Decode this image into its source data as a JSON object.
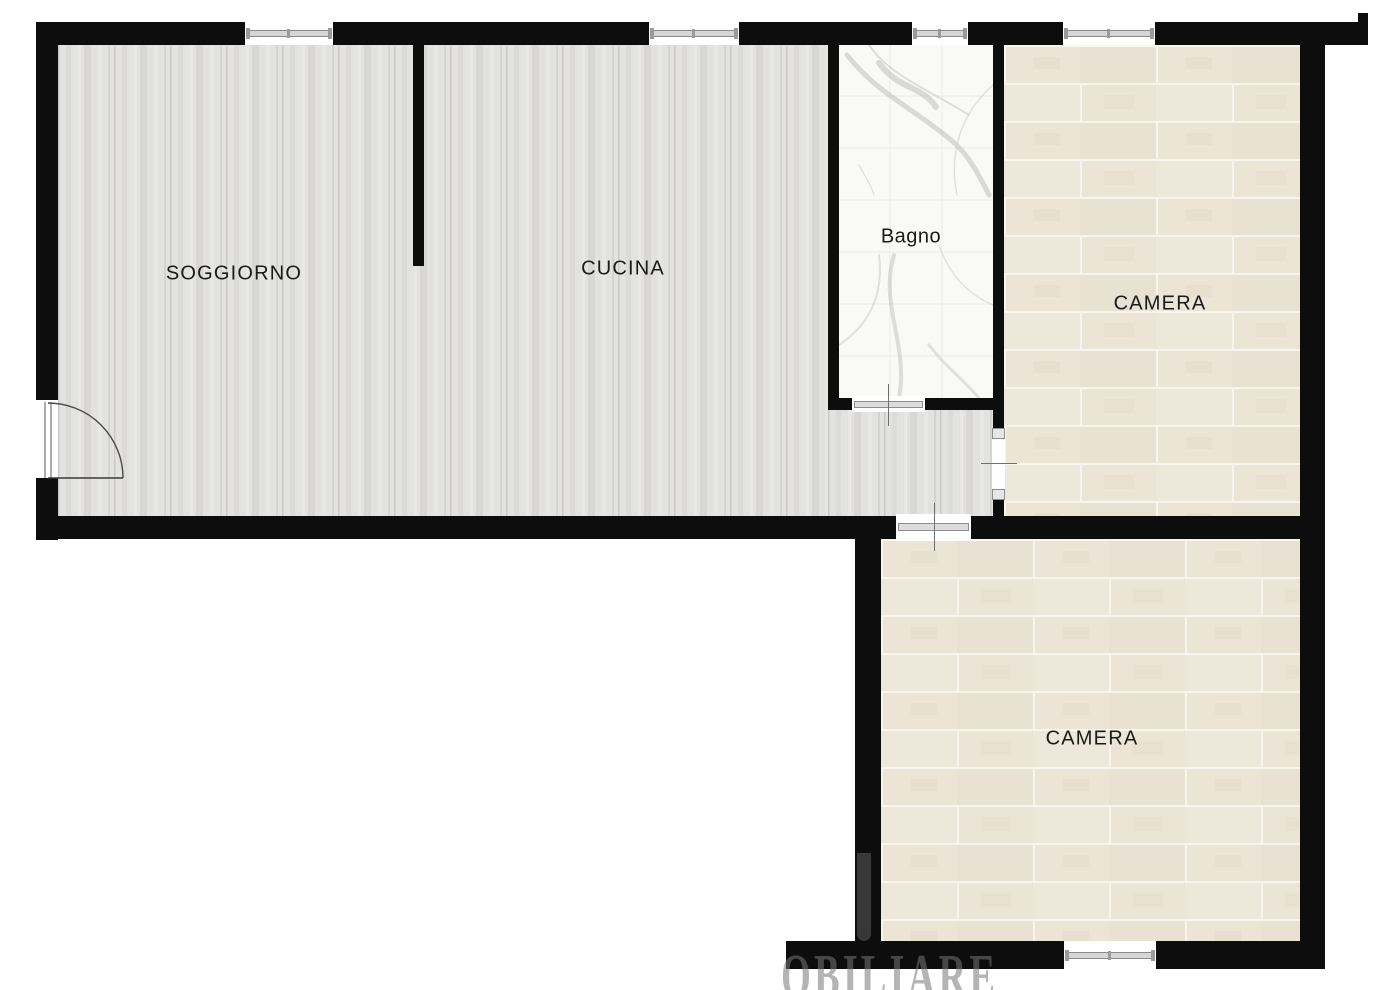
{
  "rooms": {
    "soggiorno": {
      "label": "SOGGIORNO"
    },
    "cucina": {
      "label": "CUCINA"
    },
    "bagno": {
      "label": "Bagno"
    },
    "camera_nord": {
      "label": "CAMERA"
    },
    "camera_sud": {
      "label": "CAMERA"
    }
  },
  "watermark": {
    "text": "OBILIARE"
  },
  "colors": {
    "wall": "#0d0d0d",
    "wood_floor_base": "#e2e2e0",
    "tile_floor_base": "#ece5d6",
    "tile_grout": "#f8f5ee",
    "marble_floor_base": "#f9f9f7",
    "label_text": "#1a1a1a",
    "sill_gray": "#d6d6d6"
  }
}
